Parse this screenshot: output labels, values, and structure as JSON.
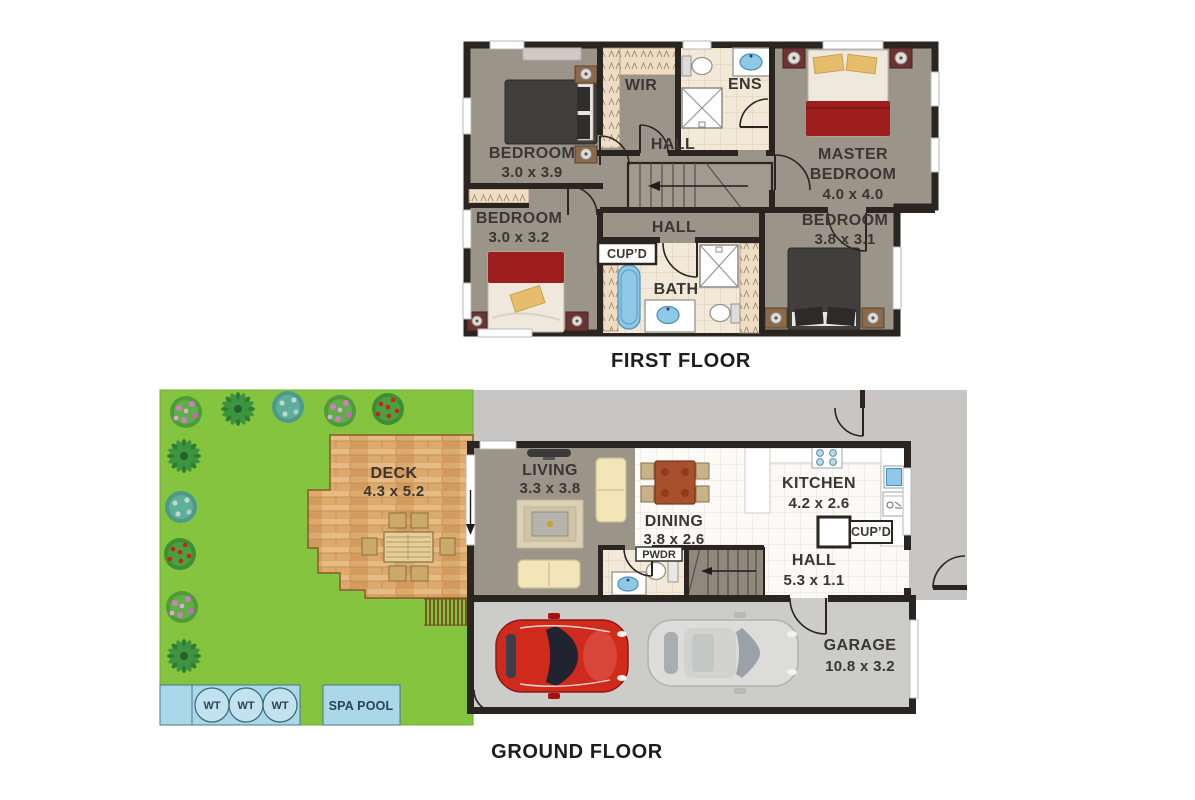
{
  "first_floor": {
    "title": "FIRST FLOOR",
    "bedroom1": {
      "name": "BEDROOM",
      "dims": "3.0 x 3.9"
    },
    "bedroom2": {
      "name": "BEDROOM",
      "dims": "3.0 x 3.2"
    },
    "bedroom3": {
      "name": "BEDROOM",
      "dims": "3.8 x 3.1"
    },
    "master": {
      "line1": "MASTER",
      "line2": "BEDROOM",
      "dims": "4.0 x 4.0"
    },
    "wir": "WIR",
    "ens": "ENS",
    "hall_upper": "HALL",
    "hall_lower": "HALL",
    "cupd": "CUP’D",
    "bath": "BATH"
  },
  "ground_floor": {
    "title": "GROUND FLOOR",
    "deck": {
      "name": "DECK",
      "dims": "4.3 x 5.2"
    },
    "living": {
      "name": "LIVING",
      "dims": "3.3 x 3.8"
    },
    "dining": {
      "name": "DINING",
      "dims": "3.8 x 2.6"
    },
    "kitchen": {
      "name": "KITCHEN",
      "dims": "4.2 x 2.6"
    },
    "hall": {
      "name": "HALL",
      "dims": "5.3 x 1.1"
    },
    "cupd": "CUP’D",
    "pwdr": "PWDR",
    "garage": {
      "name": "GARAGE",
      "dims": "10.8 x 3.2"
    },
    "spa_pool": "SPA POOL",
    "wt1": "WT",
    "wt2": "WT",
    "wt3": "WT"
  },
  "colors": {
    "wall": "#2a2521",
    "floor": "#9b9489",
    "garden": "#84c43f",
    "driveway": "#c7c6c4",
    "garage_floor": "#cccccb",
    "water": "#abd8e9",
    "bed_red": "#9e1d1d",
    "fixture_blue": "#8ec8e6",
    "car_red": "#cf2a1c",
    "car_silver": "#dcdcda",
    "deck_wood": "#ddaa6e"
  }
}
